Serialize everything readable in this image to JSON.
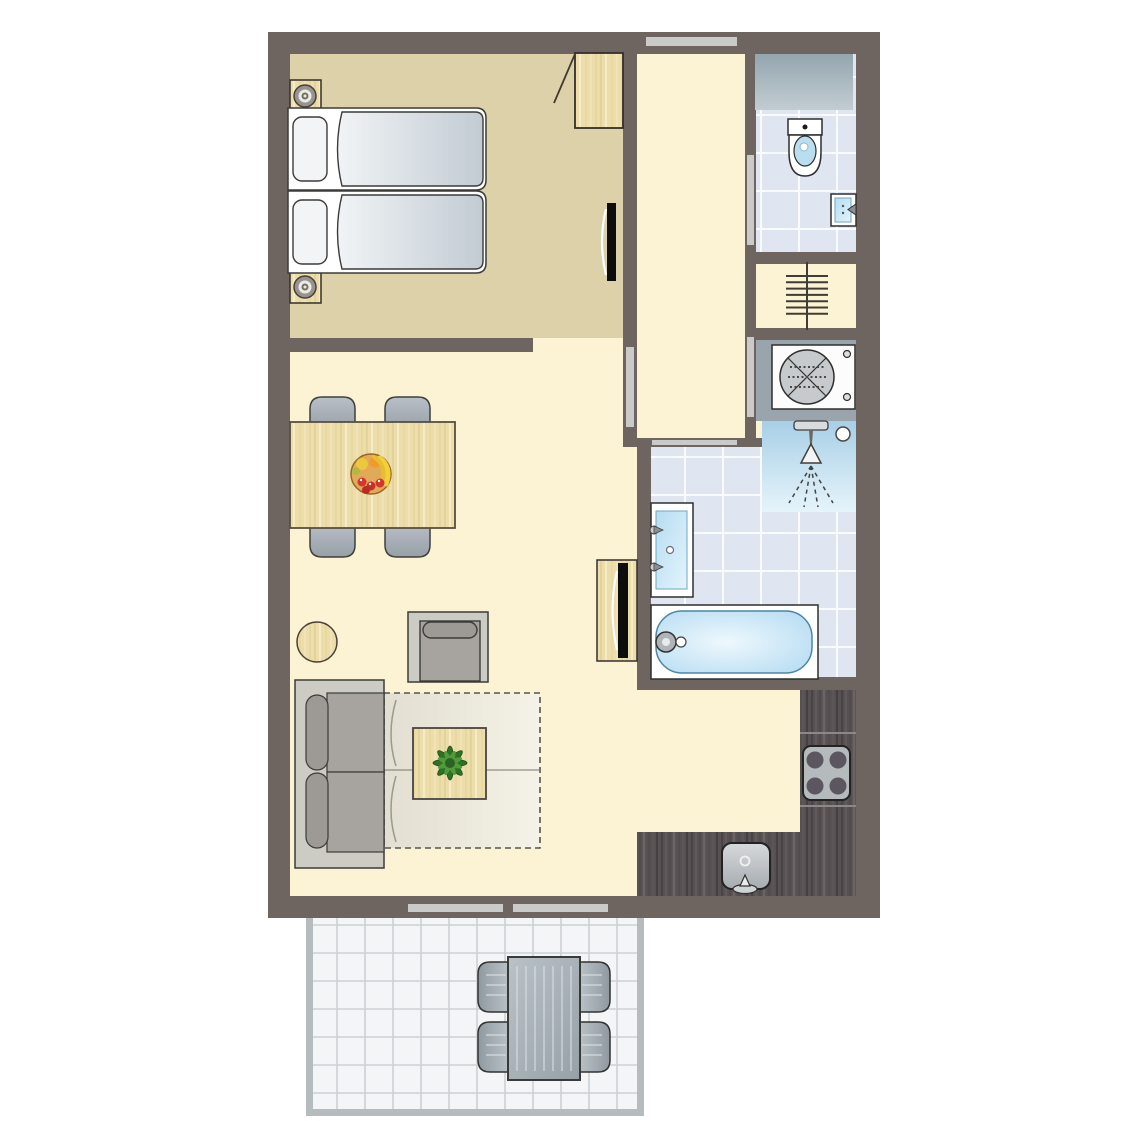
{
  "plan": {
    "type": "apartment-floor-plan",
    "colors": {
      "wall": "#6e6561",
      "floor_main": "#fcf3d4",
      "floor_bedroom": "#ddd1a9",
      "floor_tile_blue": "#dfe6f2",
      "floor_laundry": "#9aa4ad",
      "counter_dark_wood": "#575153",
      "wood_light": "#ecddab",
      "water_blue": "#bfe2f6",
      "shower_blue": "#a8cfe6",
      "terrace_tile": "#f3f5f7",
      "fixture_white": "#ffffff",
      "furniture_gray": "#a7a4a0",
      "door_window_strip": "#cacaca",
      "plant_green": "#3d8a30",
      "fruit_red": "#d5352c",
      "banana_yellow": "#f2d03c"
    },
    "rooms": [
      {
        "id": "bedroom",
        "floor": "tan"
      },
      {
        "id": "hallway",
        "floor": "cream"
      },
      {
        "id": "toilet-room",
        "floor": "blue-tile"
      },
      {
        "id": "laundry-nook",
        "floor": "gray"
      },
      {
        "id": "bathroom",
        "floor": "blue-tile"
      },
      {
        "id": "living-dining",
        "floor": "cream"
      },
      {
        "id": "kitchen",
        "floor": "cream-with-dark-counters"
      },
      {
        "id": "terrace",
        "floor": "white-tile-grid"
      }
    ],
    "furniture": {
      "bedroom": [
        "twin-bed",
        "twin-bed",
        "pillow",
        "pillow",
        "nightstand-with-lamp",
        "nightstand-with-lamp",
        "wardrobe-with-open-door",
        "wall-tv"
      ],
      "living_dining": [
        "dining-table",
        "dining-chair",
        "dining-chair",
        "dining-chair",
        "dining-chair",
        "fruit-bowl",
        "round-side-table",
        "armchair",
        "two-seat-sofa",
        "fold-out-sofa-bed-dashed",
        "coffee-table",
        "potted-plant",
        "tv-cabinet",
        "tv"
      ],
      "toilet_room": [
        "counter-top",
        "toilet",
        "hand-basin"
      ],
      "hallway": [
        "radiator"
      ],
      "laundry_nook": [
        "washing-machine"
      ],
      "bathroom": [
        "shower-corner",
        "shower-head",
        "floor-drain",
        "washbasin-vanity",
        "bathtub"
      ],
      "kitchen": [
        "l-shaped-counter",
        "stove-4-burner",
        "kitchen-sink"
      ],
      "terrace": [
        "patio-table",
        "patio-chair",
        "patio-chair",
        "patio-chair",
        "patio-chair"
      ]
    },
    "openings": {
      "front_door": 1,
      "sliding_doors": 4,
      "terrace_windows": 2
    },
    "counts": {
      "beds": 2,
      "dining_chairs": 4,
      "patio_chairs": 4,
      "stove_burners": 4
    }
  }
}
